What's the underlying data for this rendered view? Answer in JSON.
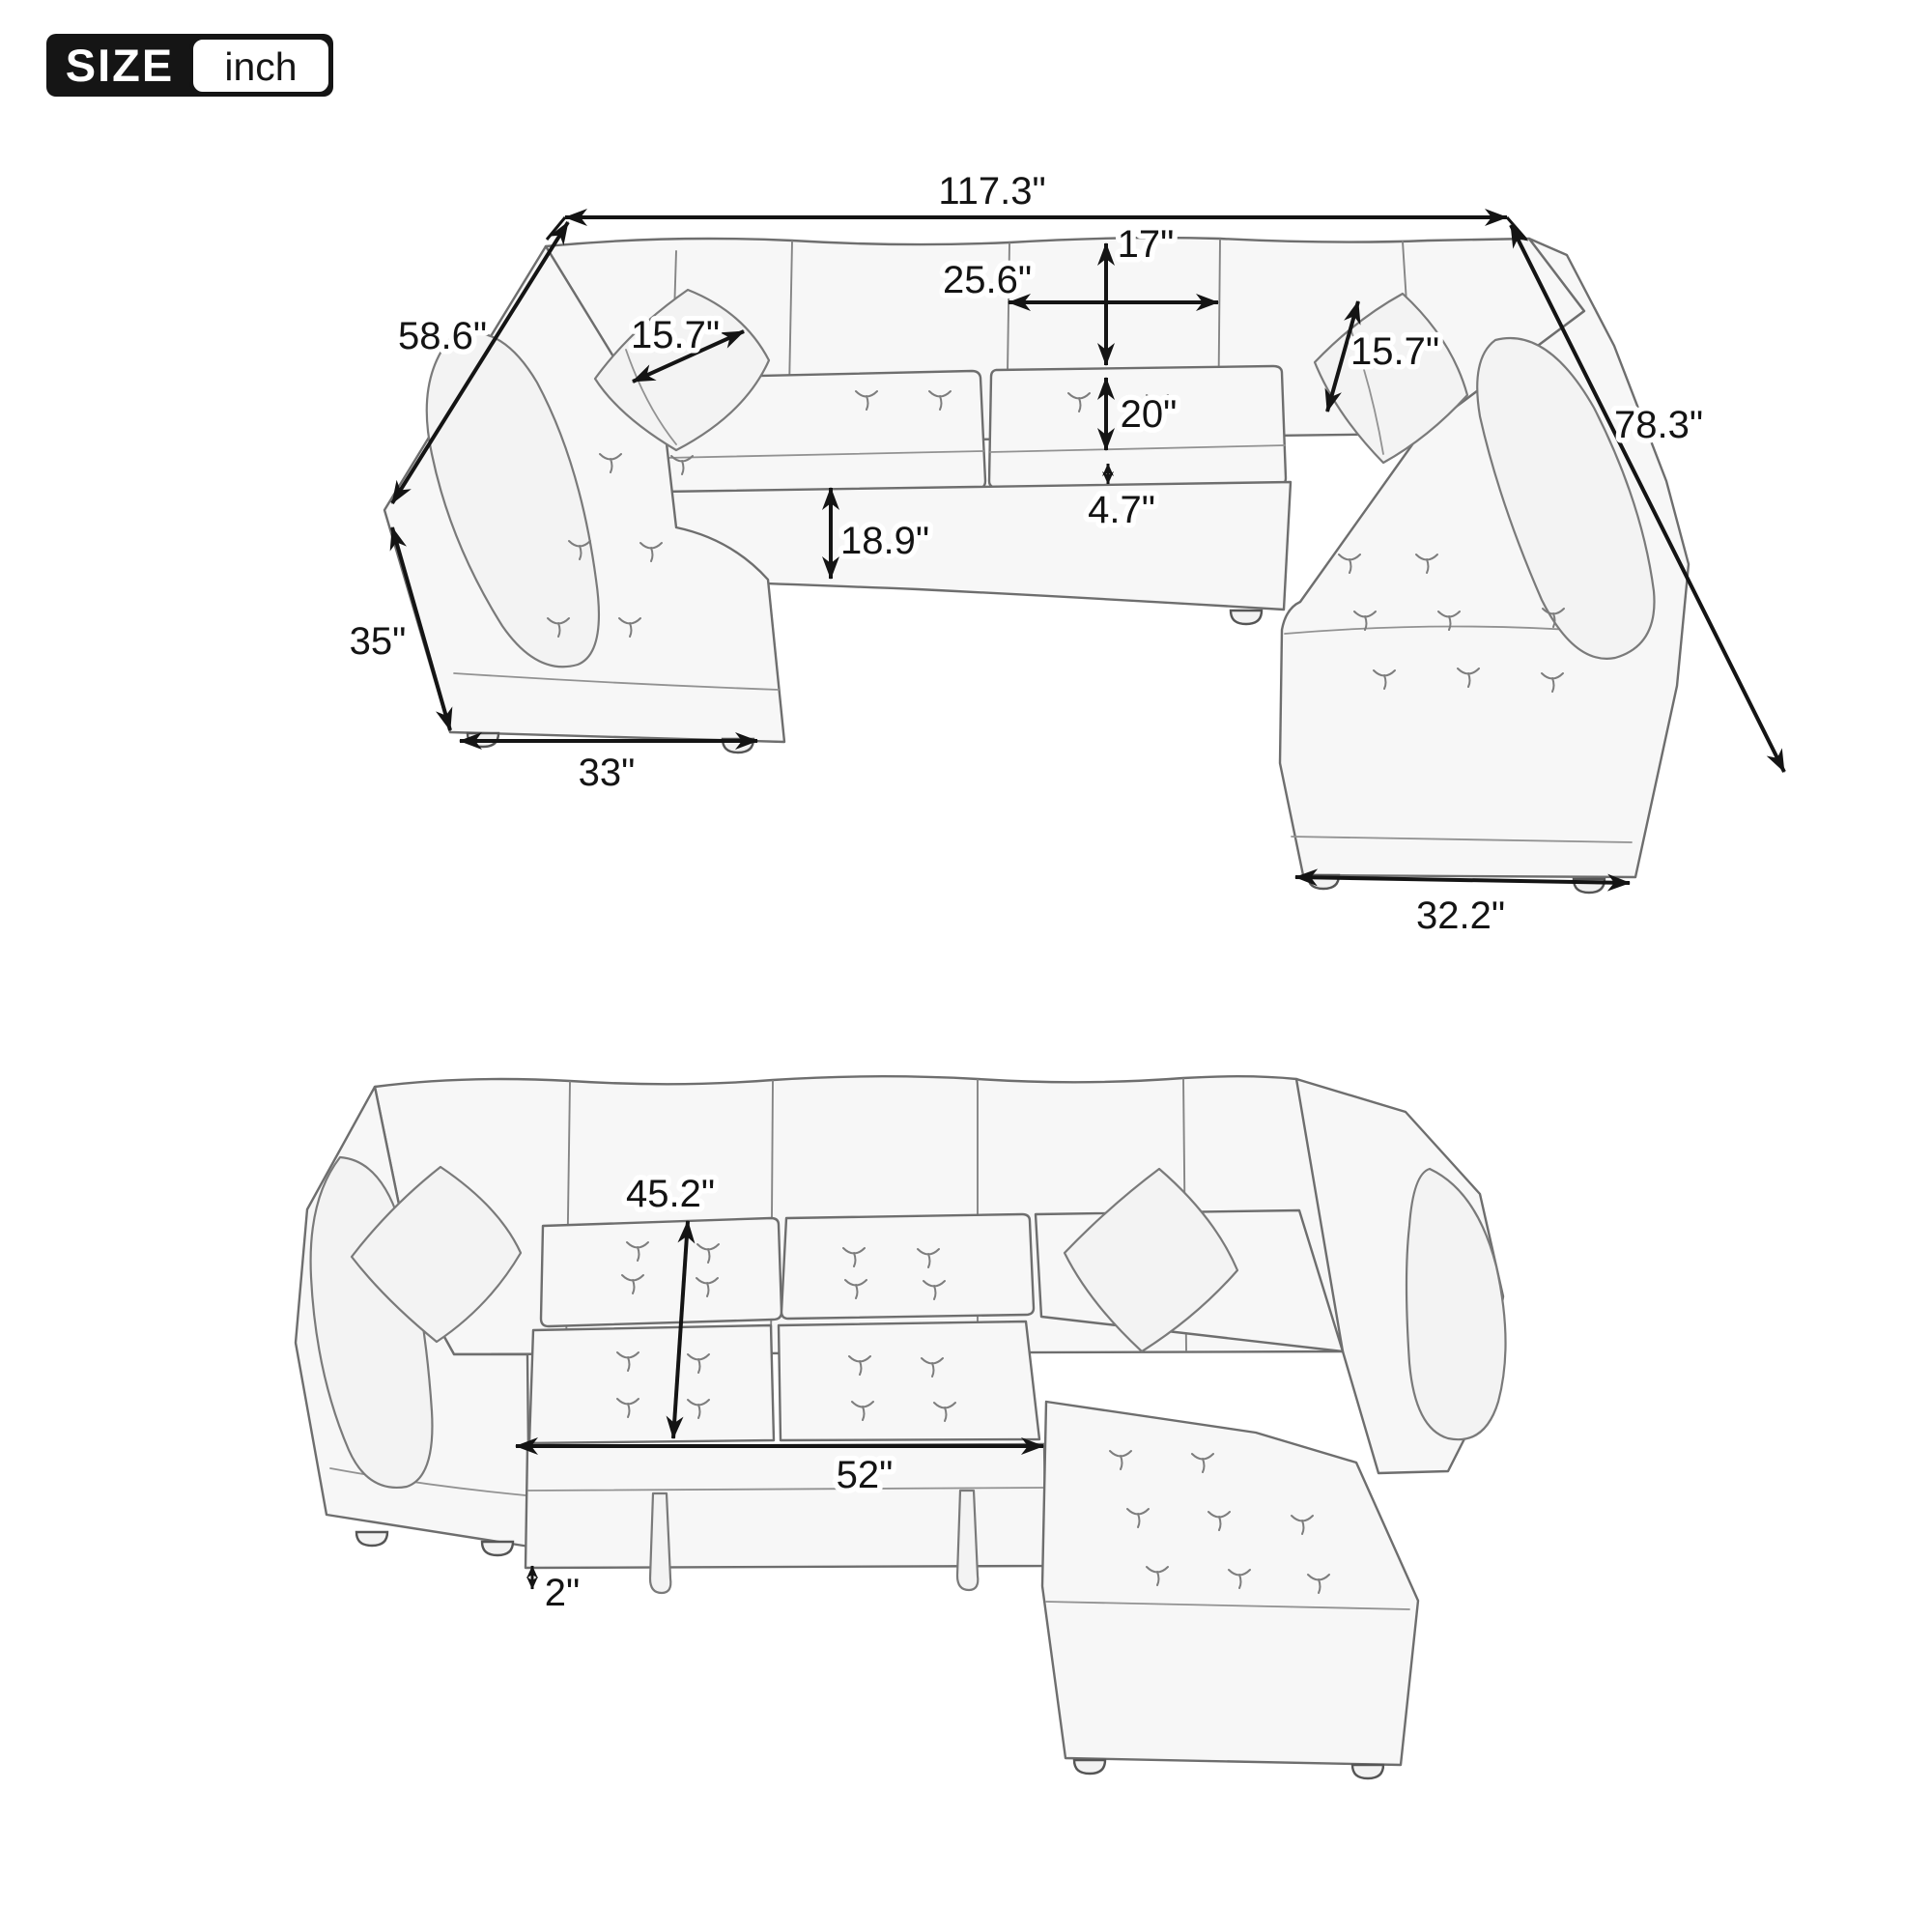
{
  "badge": {
    "label": "SIZE",
    "unit": "inch"
  },
  "views": {
    "top": {
      "description": "U-shaped sleeper sectional sofa, perspective view with overall dimensions",
      "dims": {
        "overall_width": "117.3\"",
        "left_depth": "58.6\"",
        "right_depth": "78.3\"",
        "back_height": "17\"",
        "seat_width": "25.6\"",
        "seat_depth": "20\"",
        "cushion_front": "4.7\"",
        "front_height": "18.9\"",
        "arm_height": "35\"",
        "corner_width": "33\"",
        "chaise_width": "32.2\"",
        "pillow_left": "15.7\"",
        "pillow_right": "15.7\""
      }
    },
    "bottom": {
      "description": "Sectional with pull-out sleeper bed extended, front view",
      "dims": {
        "bed_depth": "45.2\"",
        "bed_width": "52\"",
        "leg_height": "2\""
      }
    }
  },
  "colors": {
    "dimension_line": "#141414",
    "sketch_line": "#6e6e6e",
    "fabric_fill": "#f7f7f7",
    "background": "#ffffff"
  }
}
